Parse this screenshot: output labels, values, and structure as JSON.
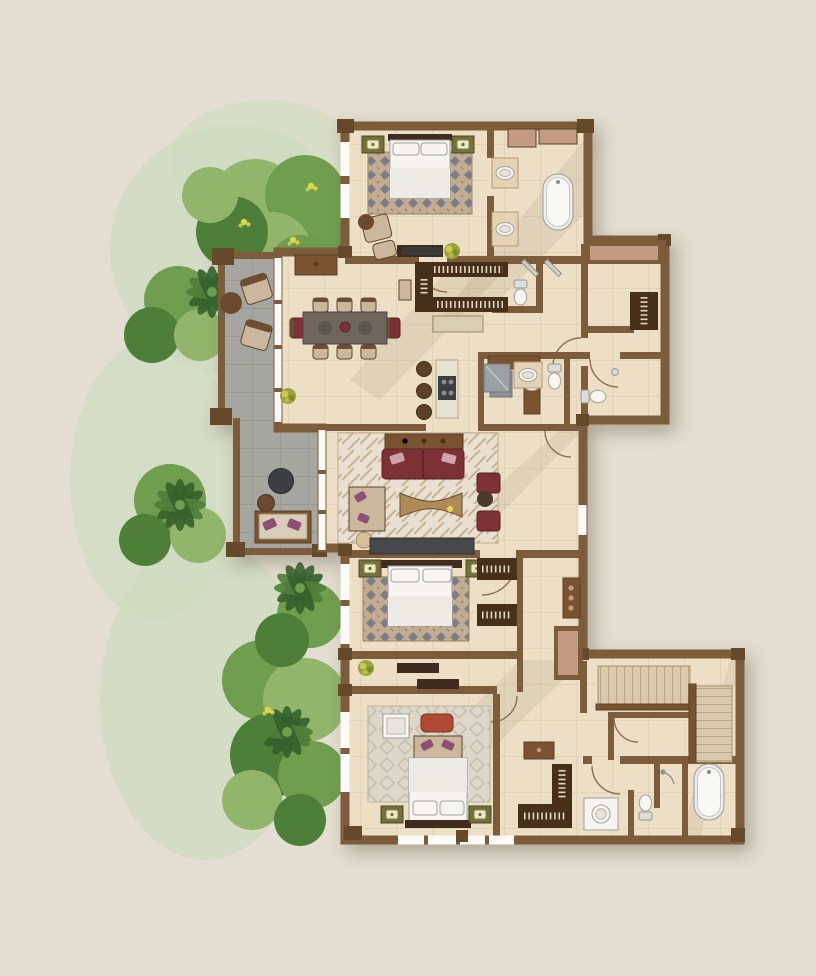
{
  "scene": {
    "type": "architectural-floor-plan-rendering",
    "style": "hand-painted watercolor residential floor plan, no text labels",
    "rooms": [
      "bedroom-top",
      "bathroom-top",
      "walk-in-closet",
      "entry-foyer",
      "dining-room",
      "kitchen",
      "living-room",
      "terrace-upper",
      "terrace-lower",
      "bathroom-middle",
      "powder-room",
      "bedroom-middle",
      "hall-corridor",
      "bedroom-bottom",
      "dressing-area",
      "bathroom-bottom",
      "staircase"
    ],
    "furniture": {
      "beds": 3,
      "bathtubs": 2,
      "toilets": 4,
      "sinks": 6,
      "dining_seats": 8,
      "bar_stools": 3,
      "sofas": 2,
      "armchairs": 4,
      "closet_racks": 7,
      "stair_runs": 2,
      "plants": 4
    },
    "vegetation": "tropical garden band along the west side with palms, shrubs and yellow blossoms"
  },
  "palette": {
    "bg": "#e3ded1",
    "wall": "#7d5c3b",
    "wallDark": "#5a402a",
    "post": "#66482b",
    "floor": "#ecdfc5",
    "floorWarm": "#e3d2b4",
    "terrace": "#a6a6a0",
    "glass": "#fbfaf6",
    "woodDark": "#3e2d1e",
    "woodMid": "#7a522f",
    "woodLight": "#b08a56",
    "closet": "#463019",
    "hanger": "#ded6c4",
    "maroon": "#7c3136",
    "maroonDark": "#5d2327",
    "rugTan": "#c3ac90",
    "rugMotif": "#6a7289",
    "rugCream": "#e8e1d2",
    "rugCreamMotif": "#c9b294",
    "rugPale": "#dcd7c9",
    "rugPaleMotif": "#c4bcab",
    "white": "#f6f5f2",
    "fixStroke": "#a09e97",
    "gray": "#8e9196",
    "porch": "#c29b81",
    "stairFill": "#d9caae",
    "stairEdge": "#a98f66",
    "olive": "#73703a",
    "oliveDark": "#4c4a20",
    "lampFace": "#ece7c4",
    "greenWash": "#cadbbd",
    "greenLight": "#92b56c",
    "greenMid": "#6f9e4f",
    "greenDark": "#4e7f39",
    "greenDeep": "#35622c",
    "flower": "#e8d84e",
    "benchRed": "#b04a34",
    "pillowPurple": "#8d4f75",
    "stool": "#5a4127",
    "tableGray": "#6e665c"
  }
}
